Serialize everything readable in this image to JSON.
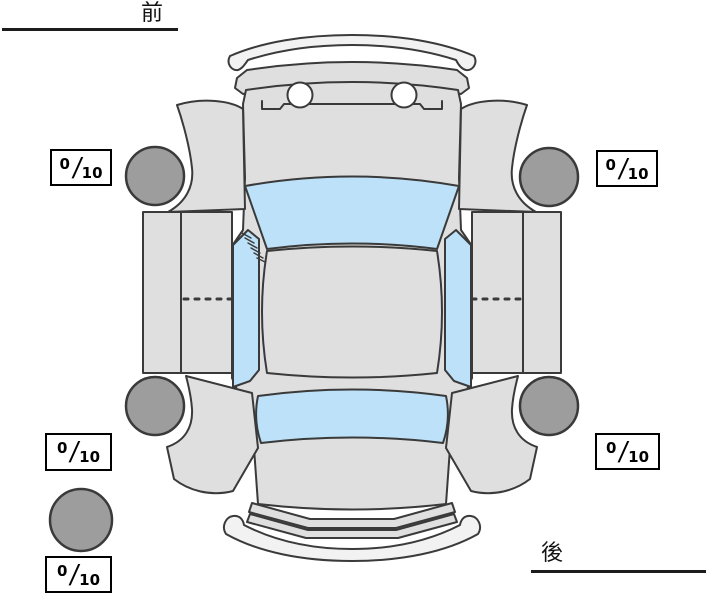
{
  "labels": {
    "front": "前",
    "rear": "後"
  },
  "score_separator": "/",
  "scores": {
    "front_left": {
      "value": "0",
      "max": "10"
    },
    "front_right": {
      "value": "0",
      "max": "10"
    },
    "rear_left": {
      "value": "0",
      "max": "10"
    },
    "rear_right": {
      "value": "0",
      "max": "10"
    },
    "spare": {
      "value": "0",
      "max": "10"
    }
  },
  "colors": {
    "body": "#dfdfdf",
    "bumper": "#f2f2f2",
    "window_glass": "#bce1f8",
    "wheel": "#9d9d9d",
    "outline": "#3a3a3a",
    "background": "#ffffff"
  }
}
